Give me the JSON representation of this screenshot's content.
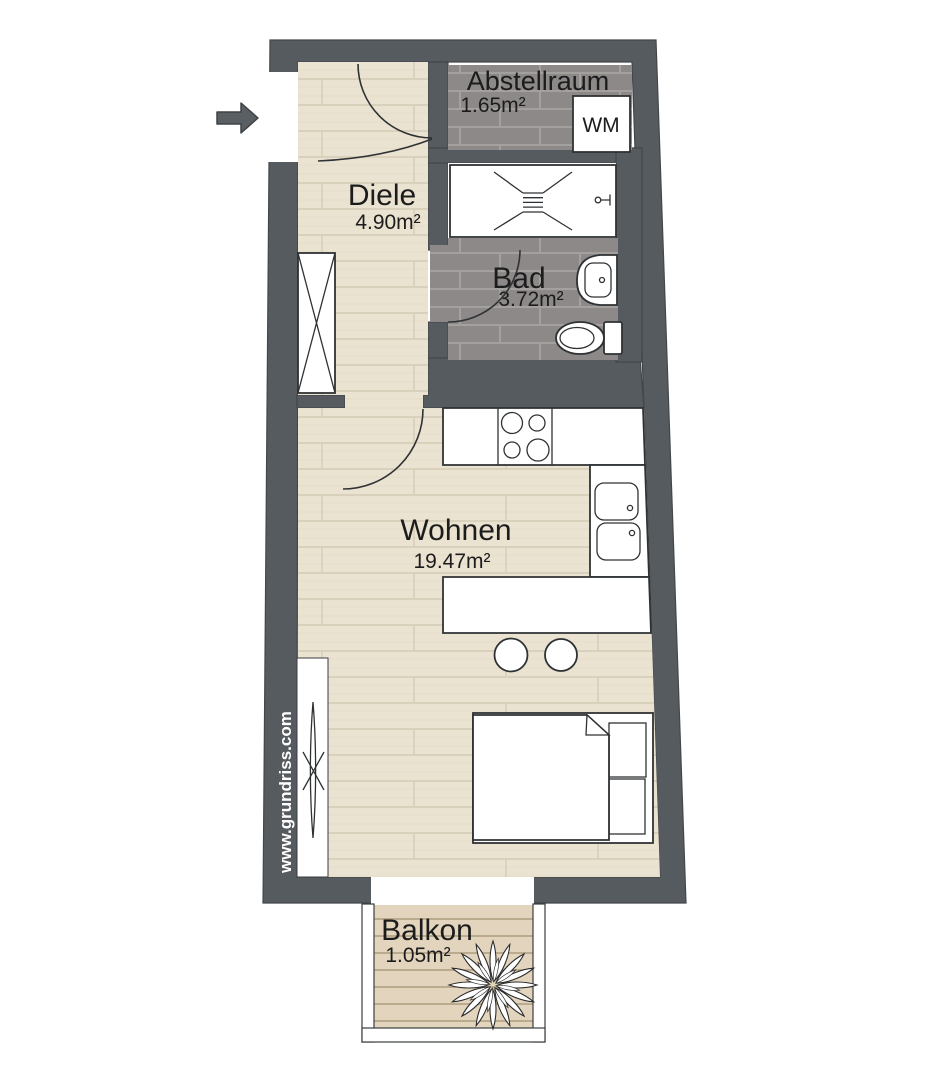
{
  "floorplan": {
    "rooms": {
      "abstellraum": {
        "name": "Abstellraum",
        "area": "1.65m²"
      },
      "diele": {
        "name": "Diele",
        "area": "4.90m²"
      },
      "bad": {
        "name": "Bad",
        "area": "3.72m²"
      },
      "wohnen": {
        "name": "Wohnen",
        "area": "19.47m²"
      },
      "balkon": {
        "name": "Balkon",
        "area": "1.05m²"
      }
    },
    "appliances": {
      "washing_machine": "WM"
    },
    "watermark": "www.grundriss.com",
    "colors": {
      "wall": "#565b5f",
      "tile_floor": "#8c8988",
      "wood_floor": "#ebe3d1",
      "deck_floor": "#e3d5bd",
      "fixture_outline": "#2f3234",
      "text": "#1c1c1c",
      "watermark_text": "#ffffff"
    }
  }
}
